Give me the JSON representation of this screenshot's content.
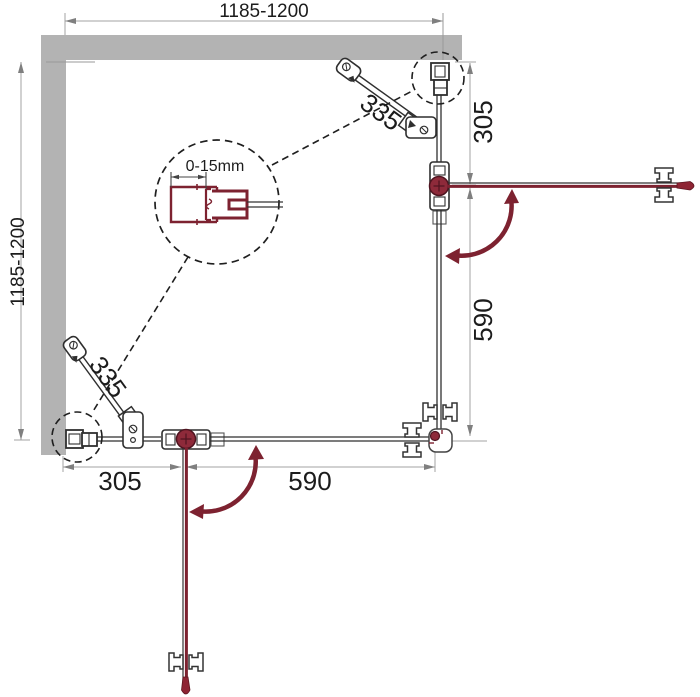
{
  "drawing": {
    "type": "technical-plan",
    "subject": "corner-entry square shower enclosure, top view installation drawing",
    "dimensions": {
      "overall_width": "1185-1200",
      "overall_depth": "1185-1200",
      "right_fixed_panel": "305",
      "right_door": "590",
      "bottom_fixed_panel": "305",
      "bottom_door": "590",
      "support_bar_right": "335",
      "support_bar_bottom": "335",
      "wall_profile_adjustment": "0-15mm"
    },
    "colors": {
      "wall": "#b3b3b3",
      "outline": "#2f2f2f",
      "dimension_line": "#a3a3a3",
      "accent_red": "#7d2230"
    }
  }
}
